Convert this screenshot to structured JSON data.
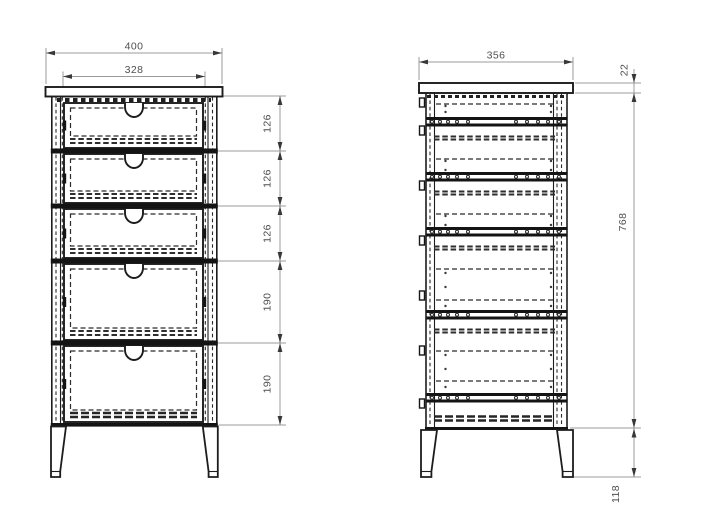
{
  "front_view": {
    "width_total": "400",
    "width_inner": "328",
    "drawer_heights": [
      {
        "label": "126"
      },
      {
        "label": "126"
      },
      {
        "label": "126"
      },
      {
        "label": "190"
      },
      {
        "label": "190"
      }
    ]
  },
  "side_view": {
    "depth": "356",
    "top_thickness": "22",
    "carcass_height": "768",
    "leg_height": "118"
  },
  "style": {
    "object_line_color": "#1c1c1c",
    "dimension_line_color": "#9b9b9b",
    "text_color": "#4f4f4f",
    "background": "#ffffff"
  }
}
